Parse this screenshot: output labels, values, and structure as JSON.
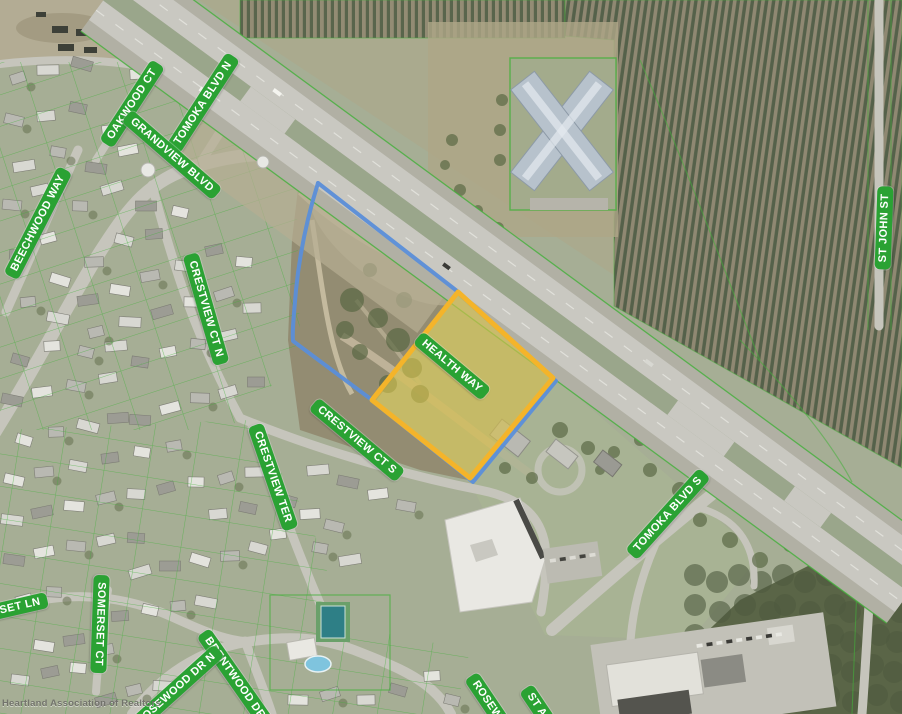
{
  "map": {
    "watermark": "Heartland Association of Realtors",
    "highlight_parcel": {
      "street_label": "HEALTH WAY",
      "outline_color": "#F4B42A",
      "fill_color": "#D9C14A",
      "boundary_line_color": "#5B8FD9"
    },
    "street_label_style": {
      "background": "#2AA233",
      "text_color": "#FFFFFF"
    },
    "parcel_line_color": "#43B03A",
    "street_labels": [
      {
        "id": "oakwood-ct",
        "text": "OAKWOOD CT",
        "x": 132,
        "y": 104,
        "rot": -57
      },
      {
        "id": "tomoka-blvd-n",
        "text": "TOMOKA BLVD N",
        "x": 203,
        "y": 103,
        "rot": -57
      },
      {
        "id": "grandview-blvd",
        "text": "GRANDVIEW BLVD",
        "x": 172,
        "y": 155,
        "rot": 41
      },
      {
        "id": "beechwood-way",
        "text": "BEECHWOOD WAY",
        "x": 38,
        "y": 223,
        "rot": -63
      },
      {
        "id": "crestview-ct-n",
        "text": "CRESTVIEW CT N",
        "x": 206,
        "y": 309,
        "rot": 74
      },
      {
        "id": "crestview-ct-s",
        "text": "CRESTVIEW CT S",
        "x": 357,
        "y": 440,
        "rot": 40
      },
      {
        "id": "crestview-ter",
        "text": "CRESTVIEW TER",
        "x": 273,
        "y": 477,
        "rot": 71
      },
      {
        "id": "health-way",
        "text": "HEALTH WAY",
        "x": 452,
        "y": 366,
        "rot": 40
      },
      {
        "id": "st-john-st",
        "text": "ST JOHN ST",
        "x": 884,
        "y": 228,
        "rot": -88
      },
      {
        "id": "tomoka-blvd-s",
        "text": "TOMOKA BLVD S",
        "x": 668,
        "y": 514,
        "rot": -48
      },
      {
        "id": "somerset-ct",
        "text": "SOMERSET CT",
        "x": 100,
        "y": 624,
        "rot": 92
      },
      {
        "id": "somerset-ln",
        "text": "RSET LN",
        "x": 16,
        "y": 607,
        "rot": -13
      },
      {
        "id": "brentwood-dr",
        "text": "BRENTWOOD DR",
        "x": 235,
        "y": 678,
        "rot": 55
      },
      {
        "id": "rosewood-dr-n",
        "text": "ROSEWOOD DR N",
        "x": 176,
        "y": 689,
        "rot": -42
      },
      {
        "id": "rosewood-s",
        "text": "ROSEW",
        "x": 487,
        "y": 700,
        "rot": 56
      },
      {
        "id": "st-a",
        "text": "ST A",
        "x": 537,
        "y": 705,
        "rot": 56
      }
    ]
  }
}
